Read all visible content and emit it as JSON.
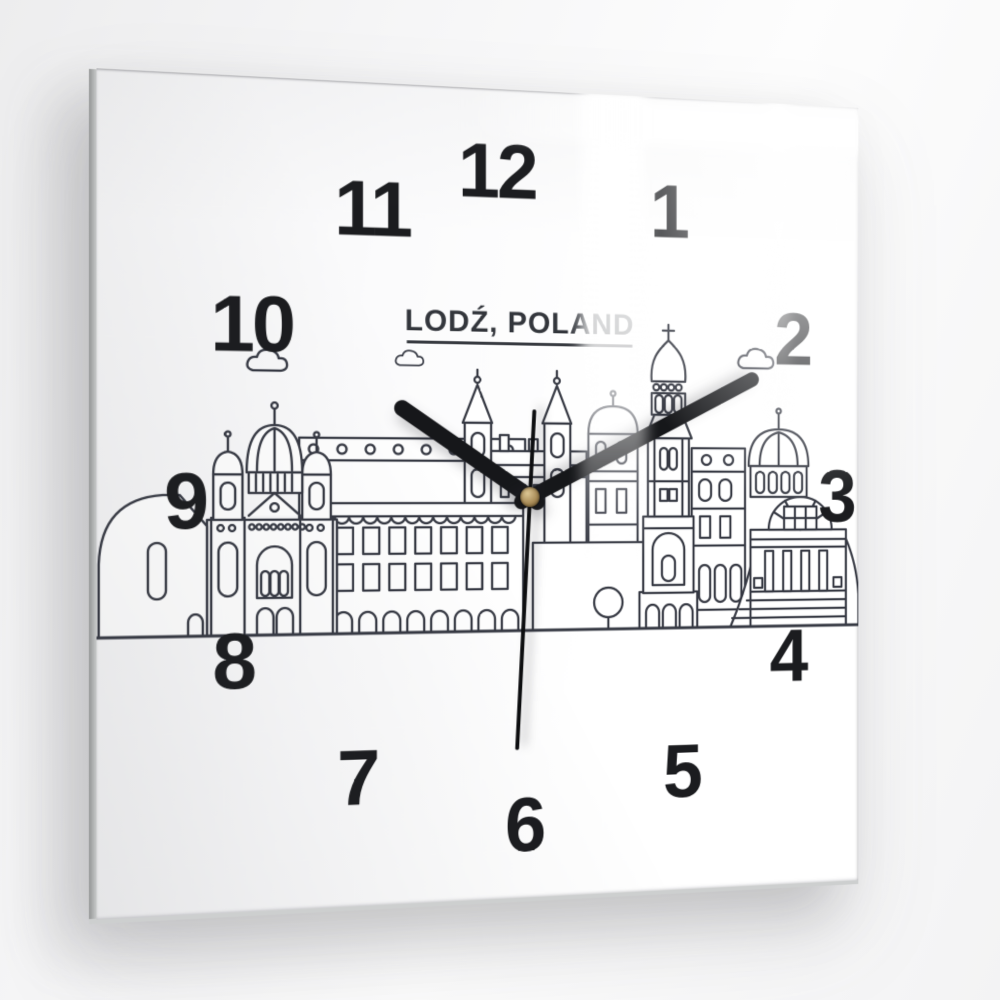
{
  "scene": {
    "description": "Product photo of a square glass wall clock hanging on a light wall, photographed at a slight angle with window reflections on the glass",
    "wall_color": "#f3f3f4"
  },
  "clock": {
    "title": "LODŹ, POLAND",
    "numerals": [
      {
        "label": "12"
      },
      {
        "label": "1"
      },
      {
        "label": "2"
      },
      {
        "label": "3"
      },
      {
        "label": "4"
      },
      {
        "label": "5"
      },
      {
        "label": "6"
      },
      {
        "label": "7"
      },
      {
        "label": "8"
      },
      {
        "label": "9"
      },
      {
        "label": "10"
      },
      {
        "label": "11"
      }
    ],
    "time_indicated": {
      "approximate_time": "10:10:30",
      "hour_hand_angle_deg": -56,
      "minute_hand_angle_deg": 63,
      "second_hand_angle_deg": 183
    },
    "artwork": {
      "name": "Lodz city skyline line art",
      "elements": [
        "cathedral with ribbed dome and twin lantern towers",
        "gothic spired towers",
        "orthodox tower with onion dome and cross",
        "classical domed building with columned portico and steps",
        "tenement block with arched arcade windows",
        "clouds",
        "round tree",
        "ground line"
      ]
    },
    "colors": {
      "face": "#ffffff",
      "numerals": "#1b1c1f",
      "line_art": "#363943",
      "hands": "#16171a",
      "center_pin_gold": "#a98c58"
    }
  }
}
